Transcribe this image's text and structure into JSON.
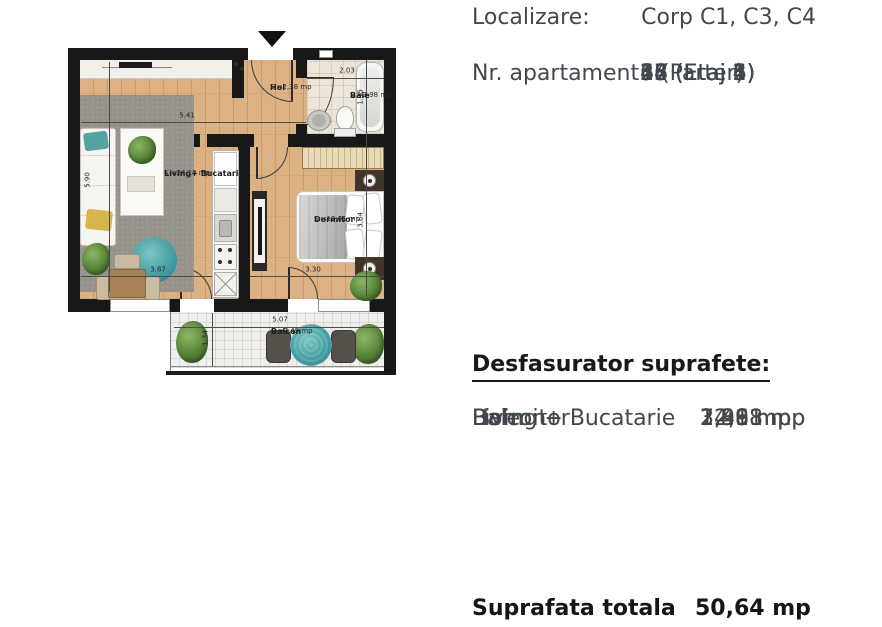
{
  "panel": {
    "localizare_label": "Localizare:",
    "localizare_value": "Corp C1, C3, C4",
    "nr_apartament_label": "Nr. apartament:",
    "apartments": [
      "2 (Parter)",
      "13 (Etaj 1)",
      "24 (Etaj 2)",
      "35 (Etaj 3)",
      "46 (Etaj 4)",
      "57 (Etaj 5)",
      "68 (Etaj 6)"
    ],
    "desfasurator_title": "Desfasurator suprafete:",
    "surfaces": [
      {
        "name": "Living + Bucatarie",
        "area": "24,18 mp"
      },
      {
        "name": "Dormitor",
        "area": "12,61 mp"
      },
      {
        "name": "Hol",
        "area": "2,38 mp"
      },
      {
        "name": "Baie",
        "area": "3,98 mp"
      },
      {
        "name": "Balcon",
        "area": "7,49 mp"
      }
    ],
    "total_label": "Suprafata totala",
    "total_value": "50,64 mp"
  },
  "floorplan": {
    "rooms": {
      "hol": {
        "name": "Hol",
        "area": "S =2,38 mp"
      },
      "baie": {
        "name": "Baie",
        "area": "S =3,98 mp"
      },
      "living": {
        "name": "Living+ Bucatarie",
        "area": "S =24,18 mp"
      },
      "dormitor": {
        "name": "Dormitor",
        "area": "S =12,61 mp"
      },
      "balcon": {
        "name": "Balcon",
        "area": "S =7,49 mp"
      }
    },
    "dimensions": {
      "living_width": "5.41",
      "living_height": "5.90",
      "dining_width": "3.87",
      "baie_width": "2.03",
      "baie_height": "1.95",
      "dormitor_width": "3.30",
      "dormitor_height": "3.64",
      "balcon_width": "5.07",
      "balcon_height": "1.34"
    },
    "colors": {
      "wall": "#181818",
      "wood": "#d9ae80",
      "accent_teal": "#3f9aa0"
    }
  }
}
